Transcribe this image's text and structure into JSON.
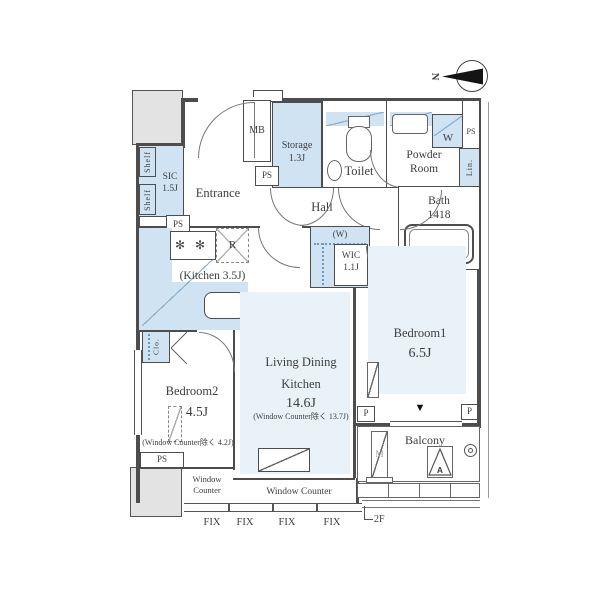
{
  "colors": {
    "closet_fill": "#cfe3f2",
    "room_fill": "#e9f2f9",
    "gray_fill": "#e3e3e3",
    "wall": "#4d4d4d"
  },
  "compass": {
    "north": "N"
  },
  "entrance_zone": {
    "entrance": "Entrance",
    "sic": {
      "name": "SIC",
      "size": "1.5J"
    },
    "shelf_top": "Shelf",
    "shelf_bottom": "Shelf",
    "ps": "PS",
    "mb": "MB"
  },
  "service_zone": {
    "storage": {
      "name": "Storage",
      "size": "1.3J"
    },
    "ps_mid": "PS",
    "toilet": "Toilet",
    "powder": {
      "line1": "Powder",
      "line2": "Room"
    },
    "washer": "W",
    "ps_right": "PS",
    "linen": "Lin.",
    "bath": {
      "name": "Bath",
      "size": "1418"
    },
    "hall": "Hall"
  },
  "kitchen_zone": {
    "label": "(Kitchen 3.5J)",
    "fridge": "R",
    "burner": "✻"
  },
  "wic": {
    "w": "(W)",
    "name": "WIC",
    "size": "1.1J"
  },
  "bedroom1": {
    "name": "Bedroom1",
    "size": "6.5J",
    "p_left": "P",
    "p_right": "P",
    "pointer": "▼"
  },
  "balcony": {
    "name": "Balcony",
    "divider": "M",
    "hatch": "A"
  },
  "bedroom2": {
    "name": "Bedroom2",
    "size": "4.5J",
    "note": "(Window Counter除く 4.2J)",
    "closet": "Clo.",
    "ps": "PS"
  },
  "ldk": {
    "line1": "Living Dining",
    "line2": "Kitchen",
    "size": "14.6J",
    "note": "(Window Counter除く 13.7J)"
  },
  "bottom": {
    "wc_small_1": "Window",
    "wc_small_2": "Counter",
    "wc_long": "Window Counter",
    "fix": [
      "FIX",
      "FIX",
      "FIX",
      "FIX"
    ],
    "floor": "2F"
  }
}
